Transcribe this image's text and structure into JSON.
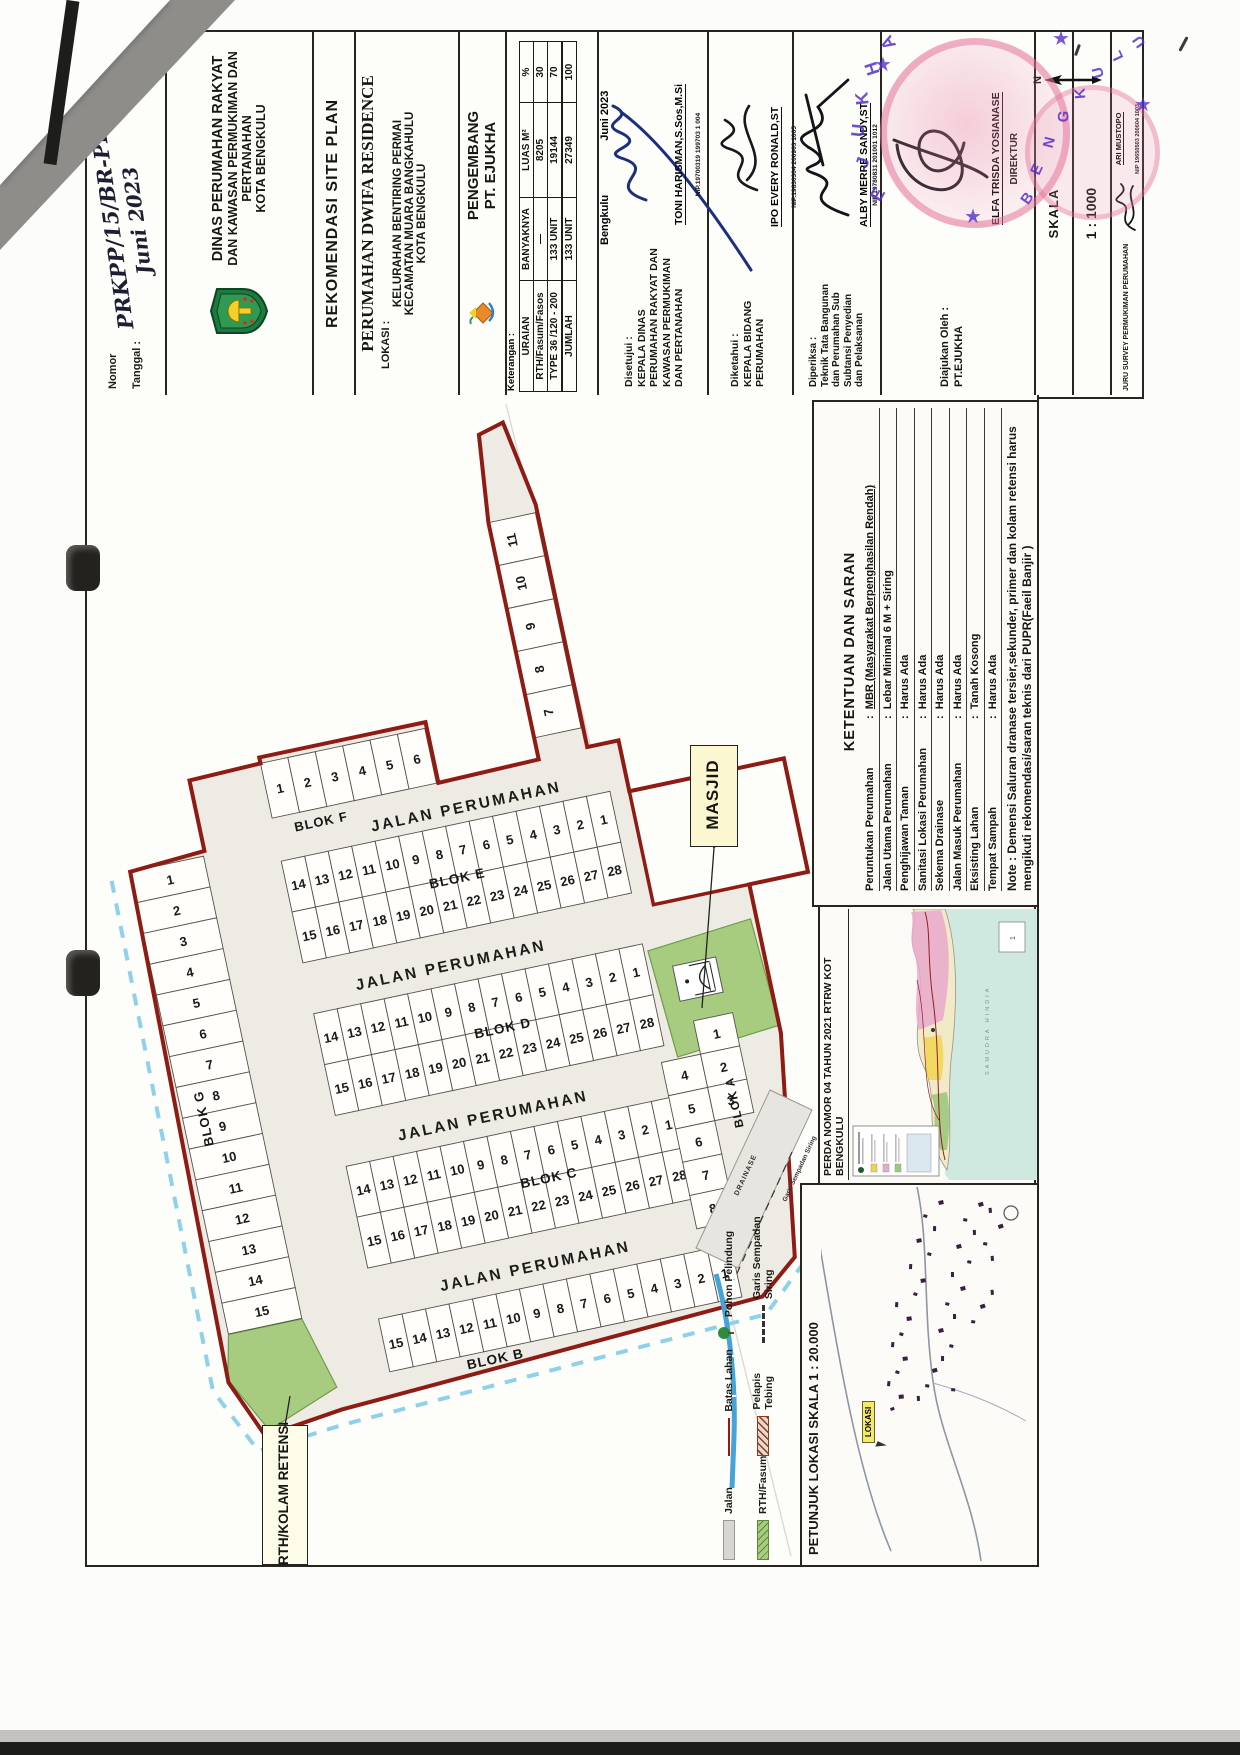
{
  "header": {
    "nomor_label": "Nomor",
    "tanggal_label": "Tanggal  :",
    "nomor_value": "PRKPP/15/BR-PRKPP/VI/2023",
    "tanggal_value": "Juni 2023",
    "dinas_lines": [
      "DINAS PERUMAHAN RAKYAT",
      "DAN KAWASAN PERMUKIMAN DAN PERTANAHAN",
      "KOTA BENGKULU"
    ],
    "rekomendasi": "REKOMENDASI  SITE PLAN",
    "perumahan_title": "PERUMAHAN DWIFA RESIDENCE",
    "lokasi_label": "LOKASI :",
    "lokasi_lines": [
      "KELURAHAN BENTIRING PERMAI",
      "KECAMATAN MUARA BANGKAHULU",
      "KOTA BENGKULU"
    ],
    "pengembang_lines": [
      "PENGEMBANG",
      "PT. EJUKHA"
    ],
    "keterangan_label": "Keterangan :",
    "table": {
      "columns": [
        "URAIAN",
        "BANYAKNYA",
        "LUAS M²",
        "%"
      ],
      "rows": [
        [
          "RTH/Fasum/Fasos",
          "—",
          "8205",
          "30"
        ],
        [
          "TYPE 36 /120 - 200",
          "133 UNIT",
          "19144",
          "70"
        ]
      ],
      "total": [
        "JUMLAH",
        "133 UNIT",
        "27349",
        "100"
      ]
    },
    "city_date_left": "Bengkulu",
    "city_date_right": "Juni 2023",
    "disetujui": {
      "label": "Disetujui :",
      "dept_lines": [
        "KEPALA DINAS",
        "PERUMAHAN RAKYAT DAN",
        "KAWASAN PERMUKIMAN",
        "DAN PERTANAHAN"
      ],
      "name": "TONI HARISMAN,S.Sos,M.Si",
      "nip": "NIP.19700319 199703 1 004"
    },
    "diketahui": {
      "label": "Diketahui :",
      "dept_lines": [
        "KEPALA BIDANG",
        "PERUMAHAN"
      ],
      "name": "IPO EVERY RONALD,ST",
      "nip": "NIP.19830304 200903 1005"
    },
    "diperiksa": {
      "label": "Diperiksa :",
      "dept_lines": [
        "Teknik Tata Bangunan",
        "dan Perumahan Sub",
        "Subtansi Penyedian",
        "dan Pelaksanan"
      ],
      "name": "ALBY MERRE SANDY,ST",
      "nip": "NIP.19780831 201001 1012"
    },
    "diajukan": {
      "label": "Diajukan Oleh :",
      "company": "PT.EJUKHA",
      "name": "ELFA TRISDA YOSIANASE",
      "title": "DIREKTUR"
    },
    "skala_label": "SKALA",
    "skala_value": "1 : 1000",
    "north_label": "N",
    "juru": {
      "label": "JURU SURVEY PERMUKIMAN PERUMAHAN",
      "name": "ARI MUSTOPO",
      "nip": "NIP 19650503 200604 1003"
    }
  },
  "stamp": {
    "company": "EJUKHA",
    "city": "BENGKULU"
  },
  "plan": {
    "street_label": "JALAN PERUMAHAN",
    "blocks": {
      "g": {
        "label": "BLOK G",
        "lots": [
          1,
          2,
          3,
          4,
          5,
          6,
          7,
          8,
          9,
          10,
          11,
          12,
          13,
          14,
          15
        ]
      },
      "f": {
        "label": "BLOK F",
        "row": [
          1,
          2,
          3,
          4,
          5,
          6
        ],
        "spur": [
          11,
          10,
          9,
          8,
          7
        ]
      },
      "e": {
        "label": "BLOK E",
        "top": [
          14,
          13,
          12,
          11,
          10,
          9,
          8,
          7,
          6,
          5,
          4,
          3,
          2,
          1
        ],
        "bottom": [
          15,
          16,
          17,
          18,
          19,
          20,
          21,
          22,
          23,
          24,
          25,
          26,
          27,
          28
        ]
      },
      "d": {
        "label": "BLOK D",
        "top": [
          14,
          13,
          12,
          11,
          10,
          9,
          8,
          7,
          6,
          5,
          4,
          3,
          2,
          1
        ],
        "bottom": [
          15,
          16,
          17,
          18,
          19,
          20,
          21,
          22,
          23,
          24,
          25,
          26,
          27,
          28
        ]
      },
      "c": {
        "label": "BLOK C",
        "top": [
          14,
          13,
          12,
          11,
          10,
          9,
          8,
          7,
          6,
          5,
          4,
          3,
          2,
          1
        ],
        "bottom": [
          15,
          16,
          17,
          18,
          19,
          20,
          21,
          22,
          23,
          24,
          25,
          26,
          27,
          28
        ]
      },
      "b": {
        "label": "BLOK B",
        "lots": [
          15,
          14,
          13,
          12,
          11,
          10,
          9,
          8,
          7,
          6,
          5,
          4,
          3,
          2,
          1
        ]
      },
      "a": {
        "label": "BLOK A",
        "col1": [
          4,
          5,
          6,
          7,
          8
        ],
        "col2": [
          1,
          2,
          3
        ]
      }
    },
    "labels": {
      "masjid": "MASJID",
      "rth": "RTH/KOLAM RETENSI",
      "area_1a": "1A",
      "drainase": "DRAINASE",
      "garis": "Garis Sempadan Siring"
    }
  },
  "ketentuan": {
    "title": "KETENTUAN DAN SARAN",
    "rows": [
      [
        "Peruntukan Perumahan",
        "MBR (Masyarakat Berpenghasilan Rendah)"
      ],
      [
        "Jalan Utama Perumahan",
        "Lebar Minimal 6 M + Siring"
      ],
      [
        "Penghijawan Taman",
        "Harus Ada"
      ],
      [
        "Sanitasi Lokasi Perumahan",
        "Harus Ada"
      ],
      [
        "Sekema Drainase",
        "Harus Ada"
      ],
      [
        "Jalan Masuk Perumahan",
        "Harus Ada"
      ],
      [
        "Eksisting Lahan",
        "Tanah Kosong"
      ],
      [
        "Tempat Sampah",
        "Harus Ada"
      ]
    ],
    "note": "Note : Demensi Saluran dranase tersier,sekunder, primer dan kolam retensi harus  mengikuti rekomendasi/saran teknis dari PUPR(Faeil Banjir )"
  },
  "perda": {
    "title": "PERDA NOMOR 04 TAHUN 2021 RTRW KOT BENGKULU",
    "sea_label": "SAMUDRA HINDIA"
  },
  "petunjuk": {
    "title": "PETUNJUK LOKASI SKALA 1 : 20.000",
    "lokasi_label": "LOKASI"
  },
  "legend": {
    "items": [
      {
        "label": "Jalan",
        "symbol": "road"
      },
      {
        "label": "Batas Lahan",
        "symbol": "boundary"
      },
      {
        "label": "Pohon Pelindung",
        "symbol": "tree"
      },
      {
        "label": "RTH/Fasum",
        "symbol": "rth"
      },
      {
        "label": "Pelapis Tebing",
        "symbol": "tebing"
      },
      {
        "label": "Garis Sempadan Siring",
        "symbol": "siring"
      }
    ]
  },
  "colors": {
    "boundary_red": "#8e1b14",
    "green_area": "#a8cc7f",
    "road_gray": "#e9e7e1",
    "water_blue": "#45a3d6",
    "siring_dash": "#8fd0ea",
    "stamp_pink": "#e489ac",
    "stamp_purple": "#5630c9",
    "label_yellow": "#fbf7d0",
    "sea_teal": "#cfe9e1"
  }
}
